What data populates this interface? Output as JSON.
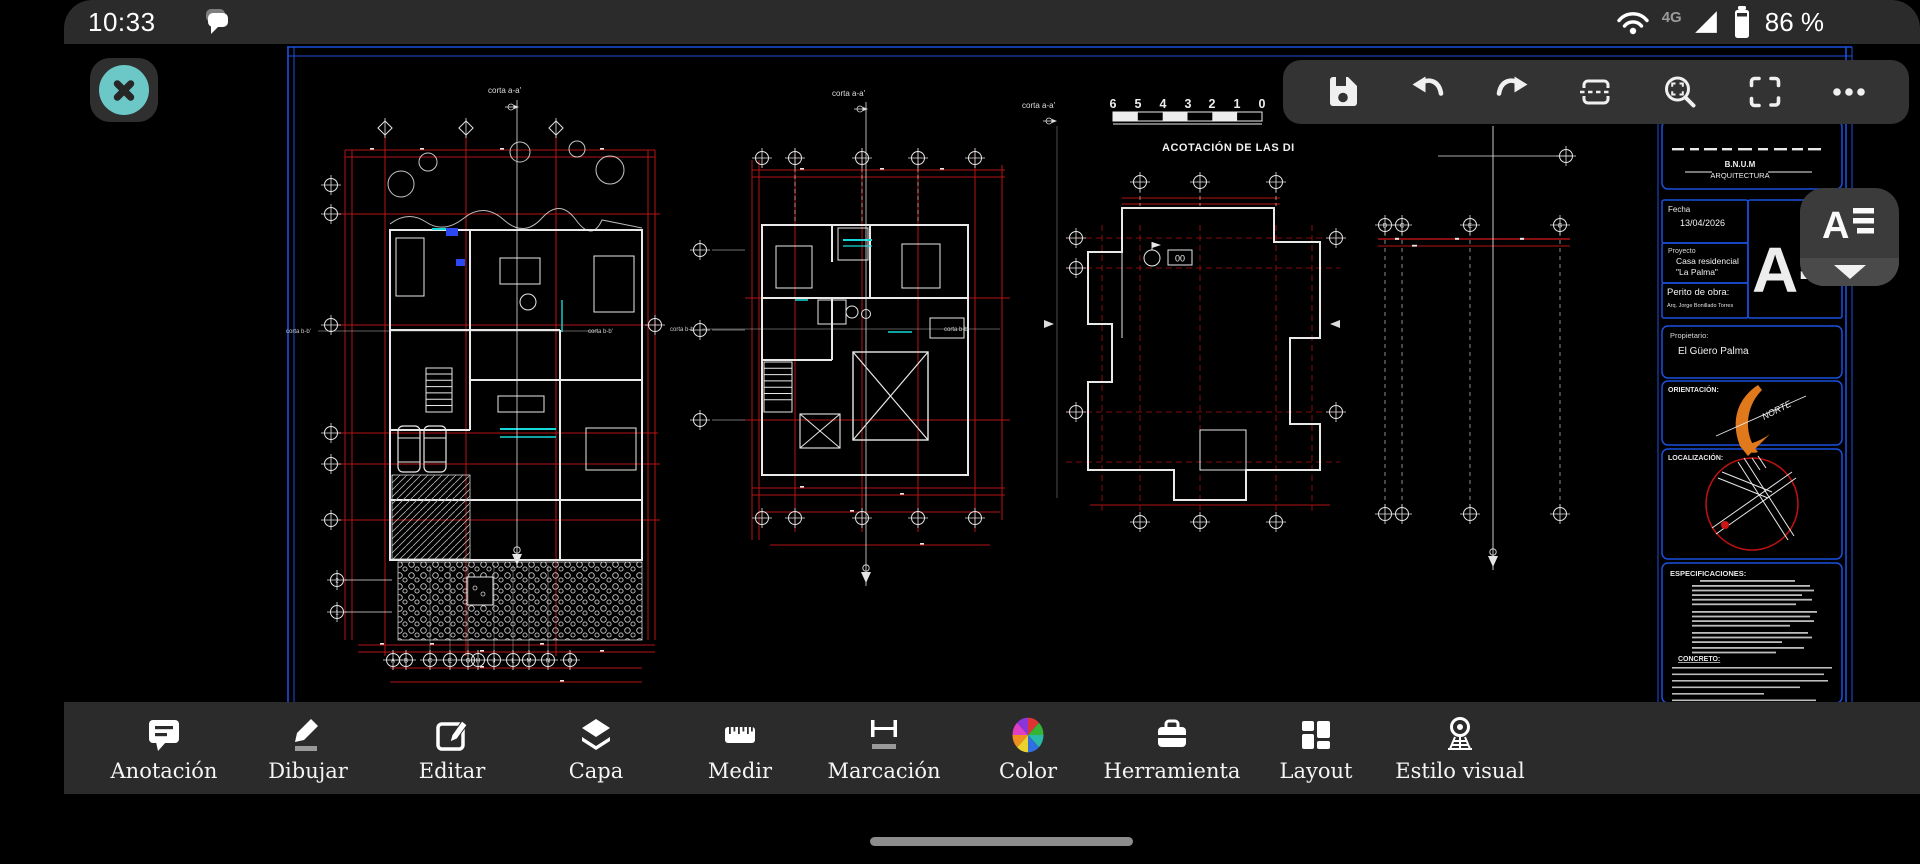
{
  "status_bar": {
    "time": "10:33",
    "network_badge": "4G",
    "battery_level": "86 %"
  },
  "top_toolbar": {
    "icons": [
      "save",
      "undo",
      "redo",
      "section",
      "zoom-window",
      "fullscreen",
      "more"
    ]
  },
  "sheet_selector": {
    "letter": "A"
  },
  "sheet": {
    "section_a_label": "corta a-a'",
    "section_b_label": "corta b-b'",
    "scale_ticks": [
      "6",
      "5",
      "4",
      "3",
      "2",
      "1",
      "0"
    ],
    "scale_caption": "ACOTACIÓN DE LAS DI",
    "roof_tag": "00",
    "grid_letters": [
      "A",
      "B",
      "C",
      "E",
      "G",
      "H",
      "J",
      "L",
      "M",
      "N",
      "O"
    ],
    "strip_letters": [
      "D",
      "C",
      "E",
      "G"
    ],
    "grid_numbers": [
      "2",
      "1"
    ],
    "title_block": {
      "firm_top": "B.N.U.M",
      "firm_bottom": "ARQUITECTURA",
      "fecha_label": "Fecha",
      "fecha_value": "13/04/2026",
      "proyecto_label": "Proyecto",
      "proyecto_line1": "Casa residencial",
      "proyecto_line2": "\"La Palma\"",
      "perito_label": "Perito de obra:",
      "perito_value": "Arq. Jorge Bonillado Torres",
      "sheet_code": "A-",
      "propietario_label": "Propietario:",
      "propietario_value": "El Güero Palma",
      "orientacion_label": "ORIENTACIÓN:",
      "norte": "NORTE",
      "localizacion_label": "LOCALIZACIÓN:",
      "especificaciones_label": "ESPECIFICACIONES:",
      "concreto_label": "CONCRETO:"
    }
  },
  "bottom_toolbar": {
    "items": [
      {
        "label": "Anotación"
      },
      {
        "label": "Dibujar"
      },
      {
        "label": "Editar"
      },
      {
        "label": "Capa"
      },
      {
        "label": "Medir"
      },
      {
        "label": "Marcación"
      },
      {
        "label": "Color"
      },
      {
        "label": "Herramienta"
      },
      {
        "label": "Layout"
      },
      {
        "label": "Estilo visual"
      }
    ]
  },
  "colors": {
    "accent_teal": "#6cc7c7",
    "frame_blue": "#1b51dd",
    "dim_red": "#b51414",
    "compass_orange": "#e0791c",
    "cad_cyan": "#17d8d8",
    "bar_bg": "#2b2b2b"
  }
}
